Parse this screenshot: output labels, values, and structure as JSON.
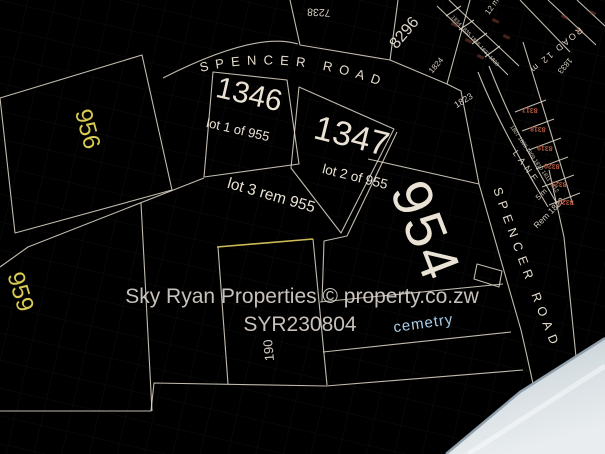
{
  "watermark": {
    "line1": "Sky Ryan Properties  ©  property.co.zw",
    "line2": "SYR230804"
  },
  "roads": {
    "spencer_top": "SPENCER ROAD",
    "spencer_right": "SPENCER ROAD",
    "road_note": "ROAD 12 m",
    "width_note": "12 m",
    "lane_name": "LANE",
    "lane_width": "5 m"
  },
  "parcels": {
    "p1346": {
      "number": "1346",
      "subtitle": "lot 1 of 955"
    },
    "p1347": {
      "number": "1347",
      "subtitle": "lot 2 of 955"
    },
    "lot3": {
      "label": "lot 3 rem 955"
    },
    "p954": {
      "number": "954",
      "feature_label": "cemetry"
    },
    "p956": {
      "number": "956"
    },
    "p959": {
      "number": "959"
    },
    "p190": {
      "number": "190"
    },
    "p7238": {
      "number": "7238"
    },
    "p8296": {
      "number": "8296"
    },
    "p1823": {
      "number": "1823"
    },
    "p1824": {
      "number": "1824"
    },
    "p1833": {
      "number": "1833"
    },
    "rem1822": {
      "label": "Rem 1822"
    }
  },
  "micro_lots": {
    "red_numbers": [
      "8317",
      "8318",
      "8319",
      "8320",
      "8321",
      "8322"
    ],
    "lane_numbers_east": "1807 1808 1809 1810 1811 1812",
    "lane_numbers_north": "1834 1835 1836 1837 1838"
  },
  "colors": {
    "parcel_line": "#ece3d4",
    "parcel_text": "#eae2d4",
    "yellow_text": "#d9cb52",
    "yellow_line": "#cdbc55",
    "cemetery_text": "#a9cfe9",
    "red_lot_text": "#b85a43",
    "watermark_text": "#d9d2cc",
    "screen_edge": "#ccd5da"
  }
}
